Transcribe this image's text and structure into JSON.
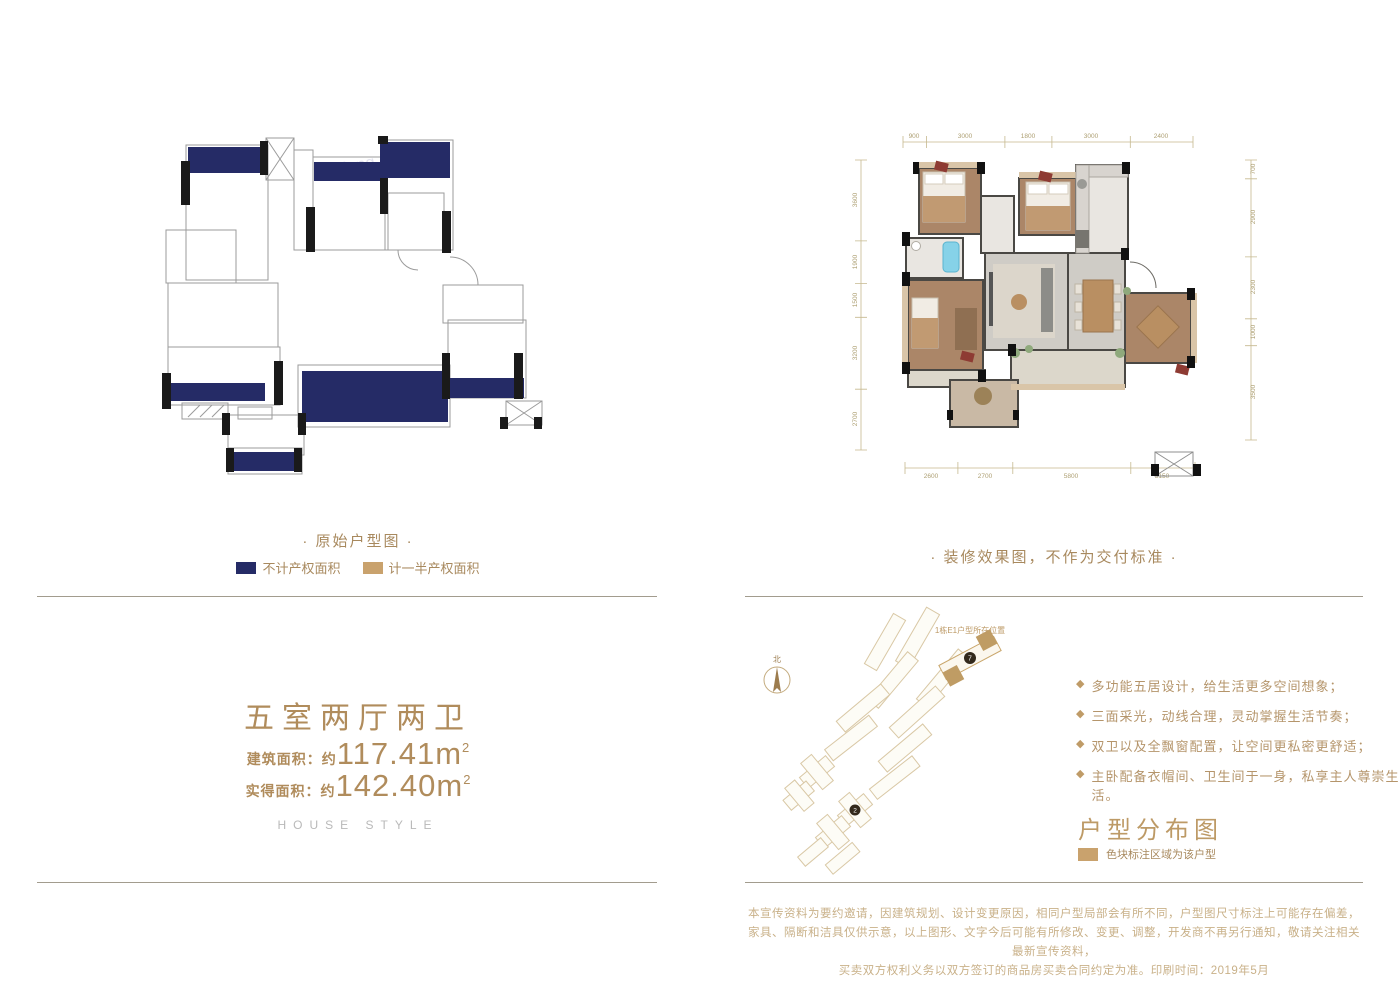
{
  "palette": {
    "navy": "#252b66",
    "tan": "#c9a26d",
    "gold_text": "#a8895e",
    "heading_gold": "#bd9a66",
    "divider": "#a29c8e",
    "disclaimer_text": "#c9b189"
  },
  "left_panel": {
    "caption": "· 原始户型图 ·",
    "legend": [
      {
        "label": "不计产权面积",
        "color": "#252b66"
      },
      {
        "label": "计一半产权面积",
        "color": "#c9a26d"
      }
    ],
    "watermark": "Fang"
  },
  "right_panel": {
    "caption": "· 装修效果图，不作为交付标准 ·",
    "dims": {
      "top": [
        "900",
        "3000",
        "1800",
        "3000",
        "2400"
      ],
      "bottom": [
        "2600",
        "2700",
        "5800",
        "3150"
      ],
      "left": [
        "3600",
        "1900",
        "1500",
        "3200",
        "2700"
      ],
      "right": [
        "700",
        "2900",
        "2300",
        "1000",
        "3500"
      ]
    }
  },
  "unit_info": {
    "title": "五室两厅两卫",
    "area_rows": [
      {
        "label": "建筑面积：约",
        "value": "117.41m",
        "sup": "2"
      },
      {
        "label": "实得面积：约",
        "value": "142.40m",
        "sup": "2"
      }
    ],
    "subtitle": "HOUSE STYLE"
  },
  "site_plan": {
    "compass_label": "北",
    "location_label": "1栋E1户型所在位置",
    "badge_primary": "7",
    "badge_secondary": "2",
    "heading": "户型分布图",
    "legend_label": "色块标注区域为该户型"
  },
  "icons": {
    "diamond": "◆"
  },
  "features": [
    "多功能五居设计，给生活更多空间想象；",
    "三面采光，动线合理，灵动掌握生活节奏；",
    "双卫以及全飘窗配置，让空间更私密更舒适；",
    "主卧配备衣帽间、卫生间于一身，私享主人尊崇生活。"
  ],
  "disclaimer": [
    "本宣传资料为要约邀请，因建筑规划、设计变更原因，相同户型局部会有所不同，户型图尺寸标注上可能存在偏差，",
    "家具、隔断和洁具仅供示意，以上图形、文字今后可能有所修改、变更、调整，开发商不再另行通知，敬请关注相关最新宣传资料，",
    "买卖双方权利义务以双方签订的商品房买卖合同约定为准。印刷时间：2019年5月"
  ]
}
